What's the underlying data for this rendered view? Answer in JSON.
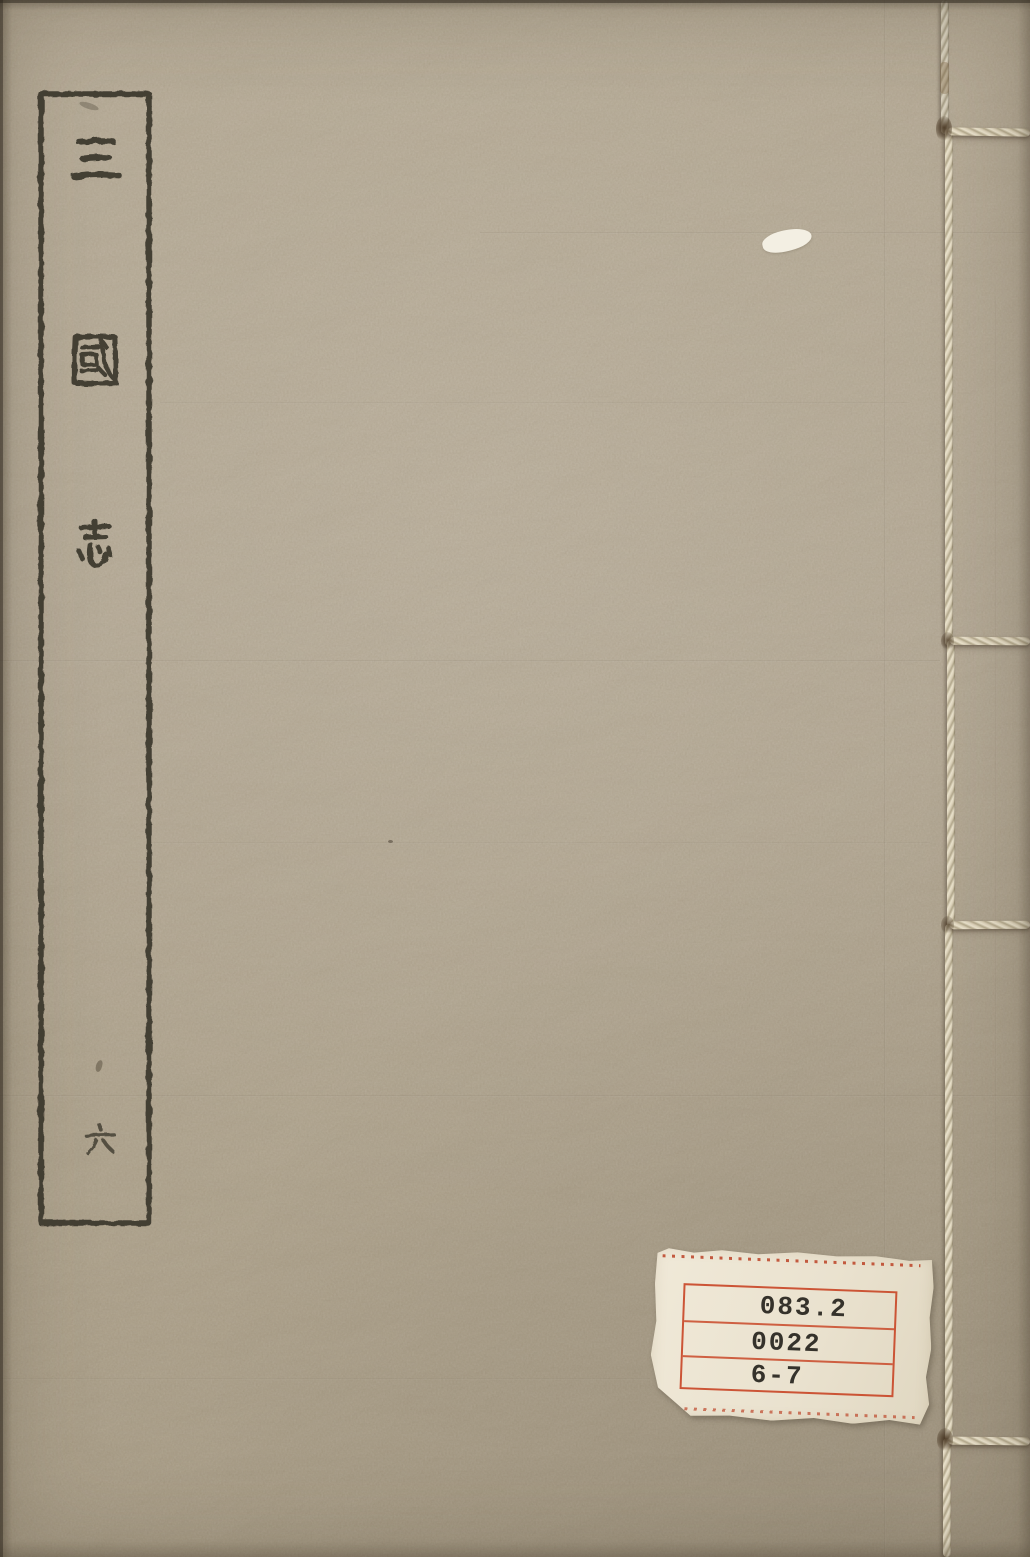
{
  "book_cover": {
    "title": "三國志",
    "title_chars": [
      "三",
      "國",
      "志"
    ],
    "volume_label": "六"
  },
  "call_number_label": {
    "lines": [
      "083.2",
      "0022",
      "6-7"
    ]
  },
  "icons": {
    "title_frame": "rectangular-ink-frame",
    "binding_thread": "thread-stitch-binding"
  },
  "colors": {
    "cover_background": "#a29580",
    "ink": "#3a362c",
    "thread": "#e4dcc6",
    "label_background": "#ece5d2",
    "label_rule_red": "#c94828",
    "label_text": "#35322b"
  }
}
